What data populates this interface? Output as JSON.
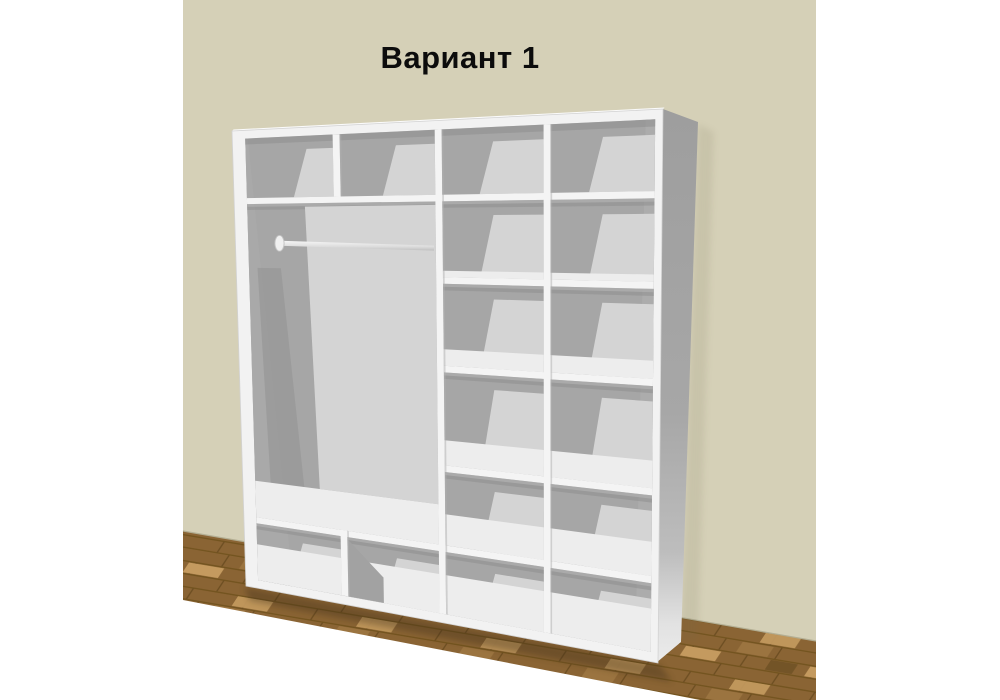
{
  "title": "Вариант 1",
  "colors": {
    "background": "#ffffff",
    "wall": "#d5d0b7",
    "floor_base": "#8a6434",
    "floor_seam": "#73541f",
    "floor_dark_block": "#6f5124",
    "floor_mid_block": "#9b7440",
    "floor_light_block": "#c49a5f",
    "cabinet_white": "#f2f2f2",
    "shelf_front": "#f4f4f4",
    "interior_gray": "#a6a6a6",
    "interior_light": "#d4d4d4",
    "shelf_surface": "#ededed",
    "title_color": "#0c0c0c"
  },
  "wardrobe": {
    "variant_label": "Вариант 1",
    "columns": [
      {
        "name": "hanging-section",
        "width": "double",
        "top_cubbies": 2,
        "clothes_rod": true,
        "lower_shelf": true,
        "bottom_cubbies": 2
      },
      {
        "name": "shelf-column-1",
        "cells": 6,
        "shelves": 5
      },
      {
        "name": "shelf-column-2",
        "cells": 6,
        "shelves": 5
      }
    ]
  }
}
